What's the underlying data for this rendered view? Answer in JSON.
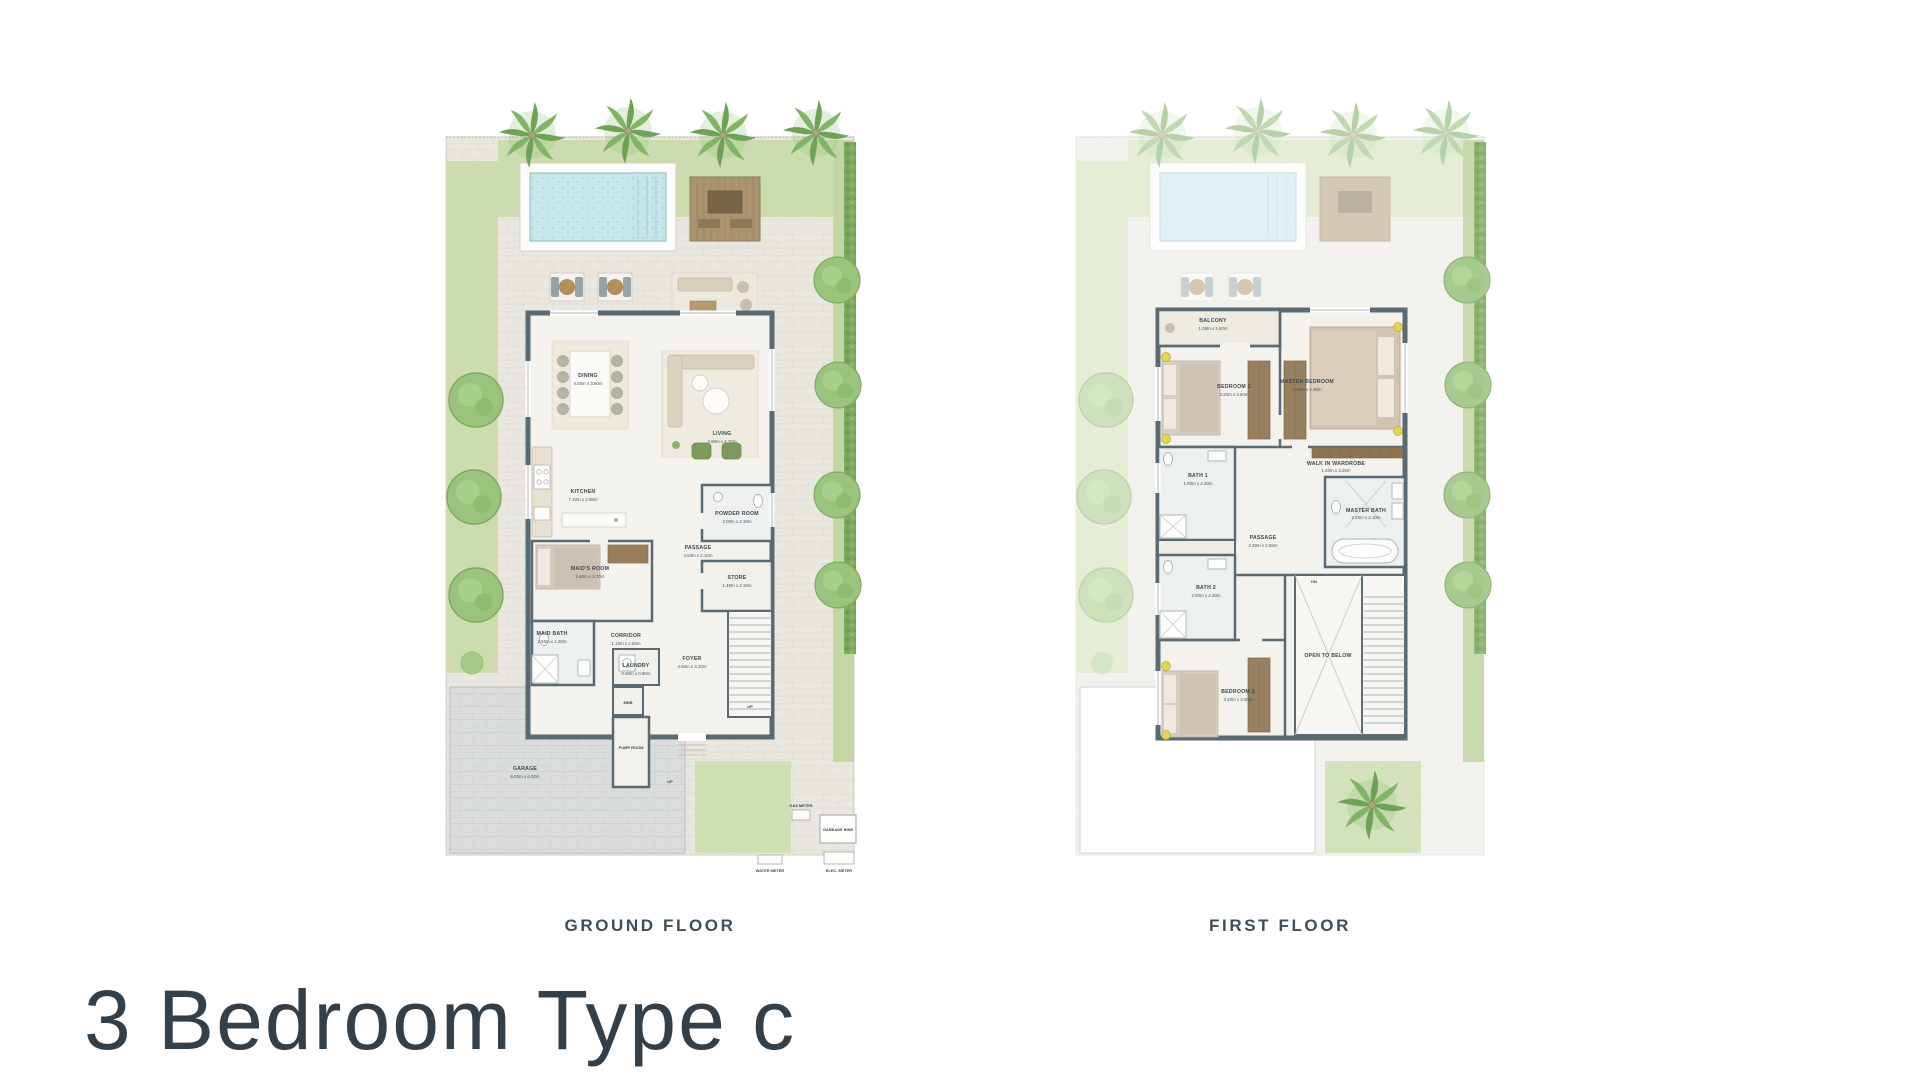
{
  "title": "3 Bedroom Type c",
  "plans": {
    "ground": {
      "caption": "GROUND FLOOR",
      "rooms": [
        {
          "name": "DINING",
          "dim": "4.50m x 3.60m"
        },
        {
          "name": "LIVING",
          "dim": "4.80m x 4.70m"
        },
        {
          "name": "KITCHEN",
          "dim": "7.40m x 3.95m"
        },
        {
          "name": "POWDER ROOM",
          "dim": "2.00m x 2.10m"
        },
        {
          "name": "PASSAGE",
          "dim": "4.50m x 2.10m"
        },
        {
          "name": "STORE",
          "dim": "1.45m x 2.10m"
        },
        {
          "name": "MAID'S ROOM",
          "dim": "2.60m x 3.70m"
        },
        {
          "name": "MAID BATH",
          "dim": "2.50m x 1.20m"
        },
        {
          "name": "CORRIDOR",
          "dim": "1.10m x 2.55m"
        },
        {
          "name": "LAUNDRY",
          "dim": "0.90m x 0.80m"
        },
        {
          "name": "FOYER",
          "dim": "4.60m x 3.20m"
        },
        {
          "name": "MDB",
          "dim": ""
        },
        {
          "name": "PUMP ROOM",
          "dim": ""
        },
        {
          "name": "GARAGE",
          "dim": "6.00m x 6.00m"
        }
      ],
      "labels": {
        "up": "UP",
        "gas": "GAS METER",
        "garbage": "GARBAGE BINS",
        "water": "WATER METER",
        "elec": "ELEC. METER"
      }
    },
    "first": {
      "caption": "FIRST FLOOR",
      "rooms": [
        {
          "name": "BALCONY",
          "dim": "1.08m x 3.60m"
        },
        {
          "name": "BEDROOM 1",
          "dim": "3.20m x 3.60m"
        },
        {
          "name": "MASTER BEDROOM",
          "dim": "3.50m x 4.45m"
        },
        {
          "name": "WALK IN WARDROBE",
          "dim": "1.20m x 3.25m"
        },
        {
          "name": "BATH 1",
          "dim": "1.90m x 2.30m"
        },
        {
          "name": "MASTER BATH",
          "dim": "3.45m x 2.10m"
        },
        {
          "name": "PASSAGE",
          "dim": "2.40m x 2.65m"
        },
        {
          "name": "BATH 2",
          "dim": "2.90m x 2.30m"
        },
        {
          "name": "BEDROOM 2",
          "dim": "3.40m x 3.60m"
        },
        {
          "name": "OPEN TO BELOW",
          "dim": ""
        }
      ],
      "labels": {
        "dn": "DN"
      }
    }
  },
  "palette": {
    "wall": "#5a6a73",
    "paving": "#e9e7e0",
    "green": "#ccdcae",
    "hedge": "#7da95e",
    "water": "#c7e6ea",
    "deck": "#a9946e",
    "label": "#39484f",
    "title": "#333f49"
  }
}
